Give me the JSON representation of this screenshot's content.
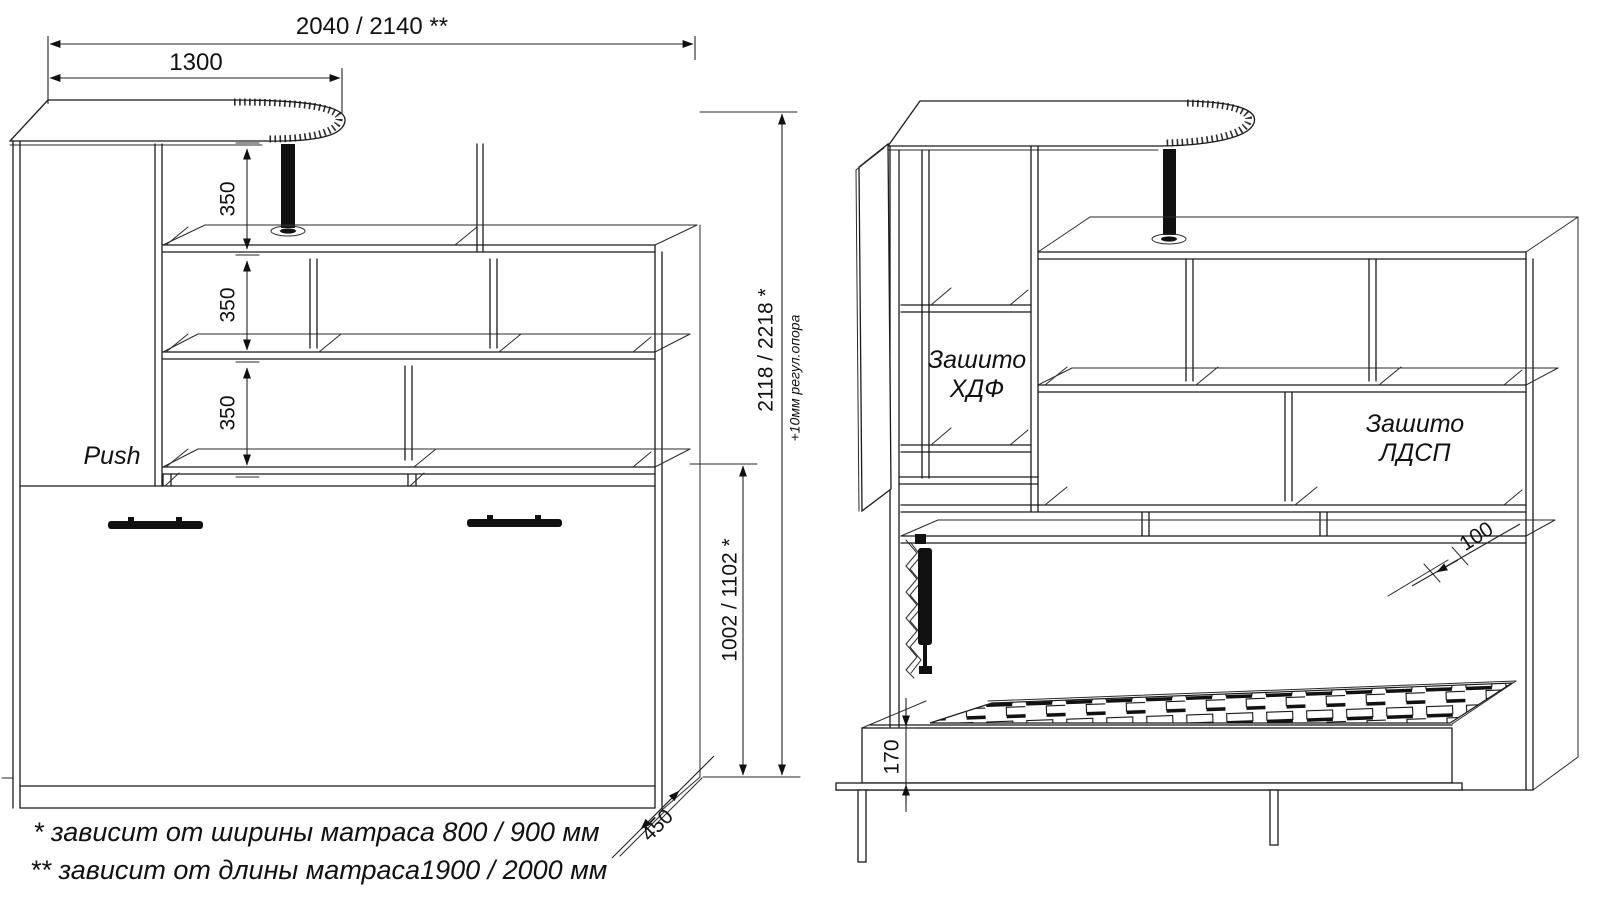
{
  "drawing": {
    "left_view": {
      "dim_overall_width": "2040 / 2140 **",
      "dim_desktop_width": "1300",
      "dim_shelf_spacing": [
        "350",
        "350",
        "350"
      ],
      "push_label": "Push",
      "dim_bed_panel_height": "1002 / 1102 *",
      "dim_total_height": "2118 / 2218 *",
      "note_adjustable_support": "+10мм регул.опора",
      "dim_depth": "450"
    },
    "right_view": {
      "label_back_hdf_line1": "Зашито",
      "label_back_hdf_line2": "ХДФ",
      "label_back_ldsp_line1": "Зашито",
      "label_back_ldsp_line2": "ЛДСП",
      "dim_shelf_depth": "100",
      "dim_bed_frame_height": "170"
    },
    "footnotes": {
      "line1": "*  зависит от ширины матраса 800 / 900 мм",
      "line2": "** зависит от длины матраса1900 / 2000 мм"
    }
  }
}
